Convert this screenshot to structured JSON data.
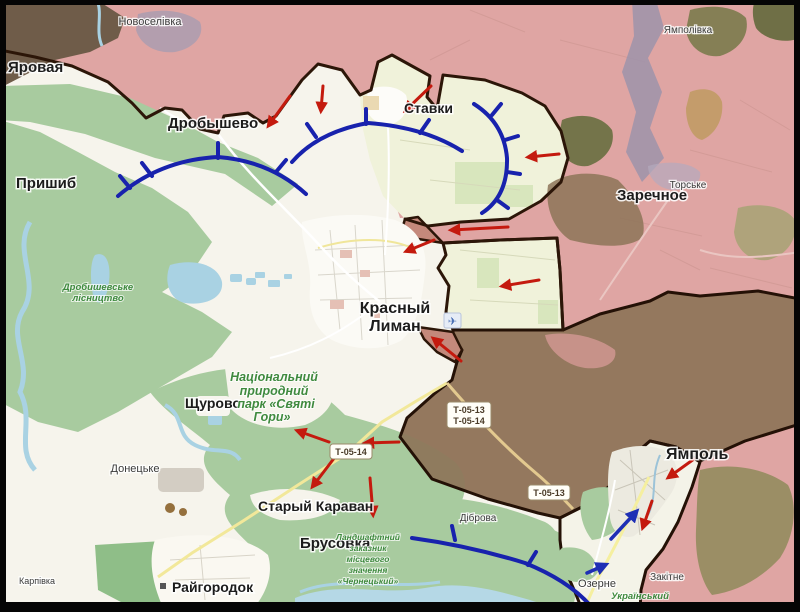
{
  "places": {
    "novoselivka": "Новоселівка",
    "yampolivka": "Ямполівка",
    "yarovaya": "Яровая",
    "prishib": "Пришиб",
    "drobyshevo": "Дробышево",
    "stavki": "Ставки",
    "zarechnoye": "Заречное",
    "torske": "Торське",
    "krasny_liman": [
      "Красный",
      "Лиман"
    ],
    "shchurovo": "Щурово",
    "donetske": "Донецьке",
    "karpivka": "Карпівка",
    "raigorodok": "Райгородок",
    "stary_karavan": "Старый Караван",
    "brusovka": "Брусовка",
    "dibrova": "Діброва",
    "yampol": "Ямполь",
    "ozerne": "Озерне",
    "zakitne": "Закітне"
  },
  "nature": {
    "sviati_hory": [
      "Національний",
      "природний",
      "парк «Святі",
      "Гори»"
    ],
    "drobyshevske_forestry": [
      "Дробишевське",
      "лісництво"
    ],
    "chernetsky_reserve": [
      "Ландшафтний",
      "заказник",
      "місцевого",
      "значення",
      "«Чернецький»"
    ],
    "ukrainian_steppe": [
      "Український",
      "степовий"
    ]
  },
  "road_shields": {
    "t_05_13": "Т-05-13",
    "t_05_14": "Т-05-14"
  },
  "icons": {
    "airport": "✈"
  },
  "colors": {
    "occupied_pink": "#dfa5a3",
    "advance_zone_brown": "#8d7458",
    "frontline_dark": "#2c1608",
    "defense_arc_blue": "#1822ad",
    "attack_arrow_red": "#c41a0e",
    "counter_arrow_blue": "#1e2fb5",
    "forest_green": "#a8cb9f",
    "fields_cream": "#f0f2da",
    "water_blue": "#a9d2e3",
    "nature_label_green": "#3f8a3f"
  }
}
